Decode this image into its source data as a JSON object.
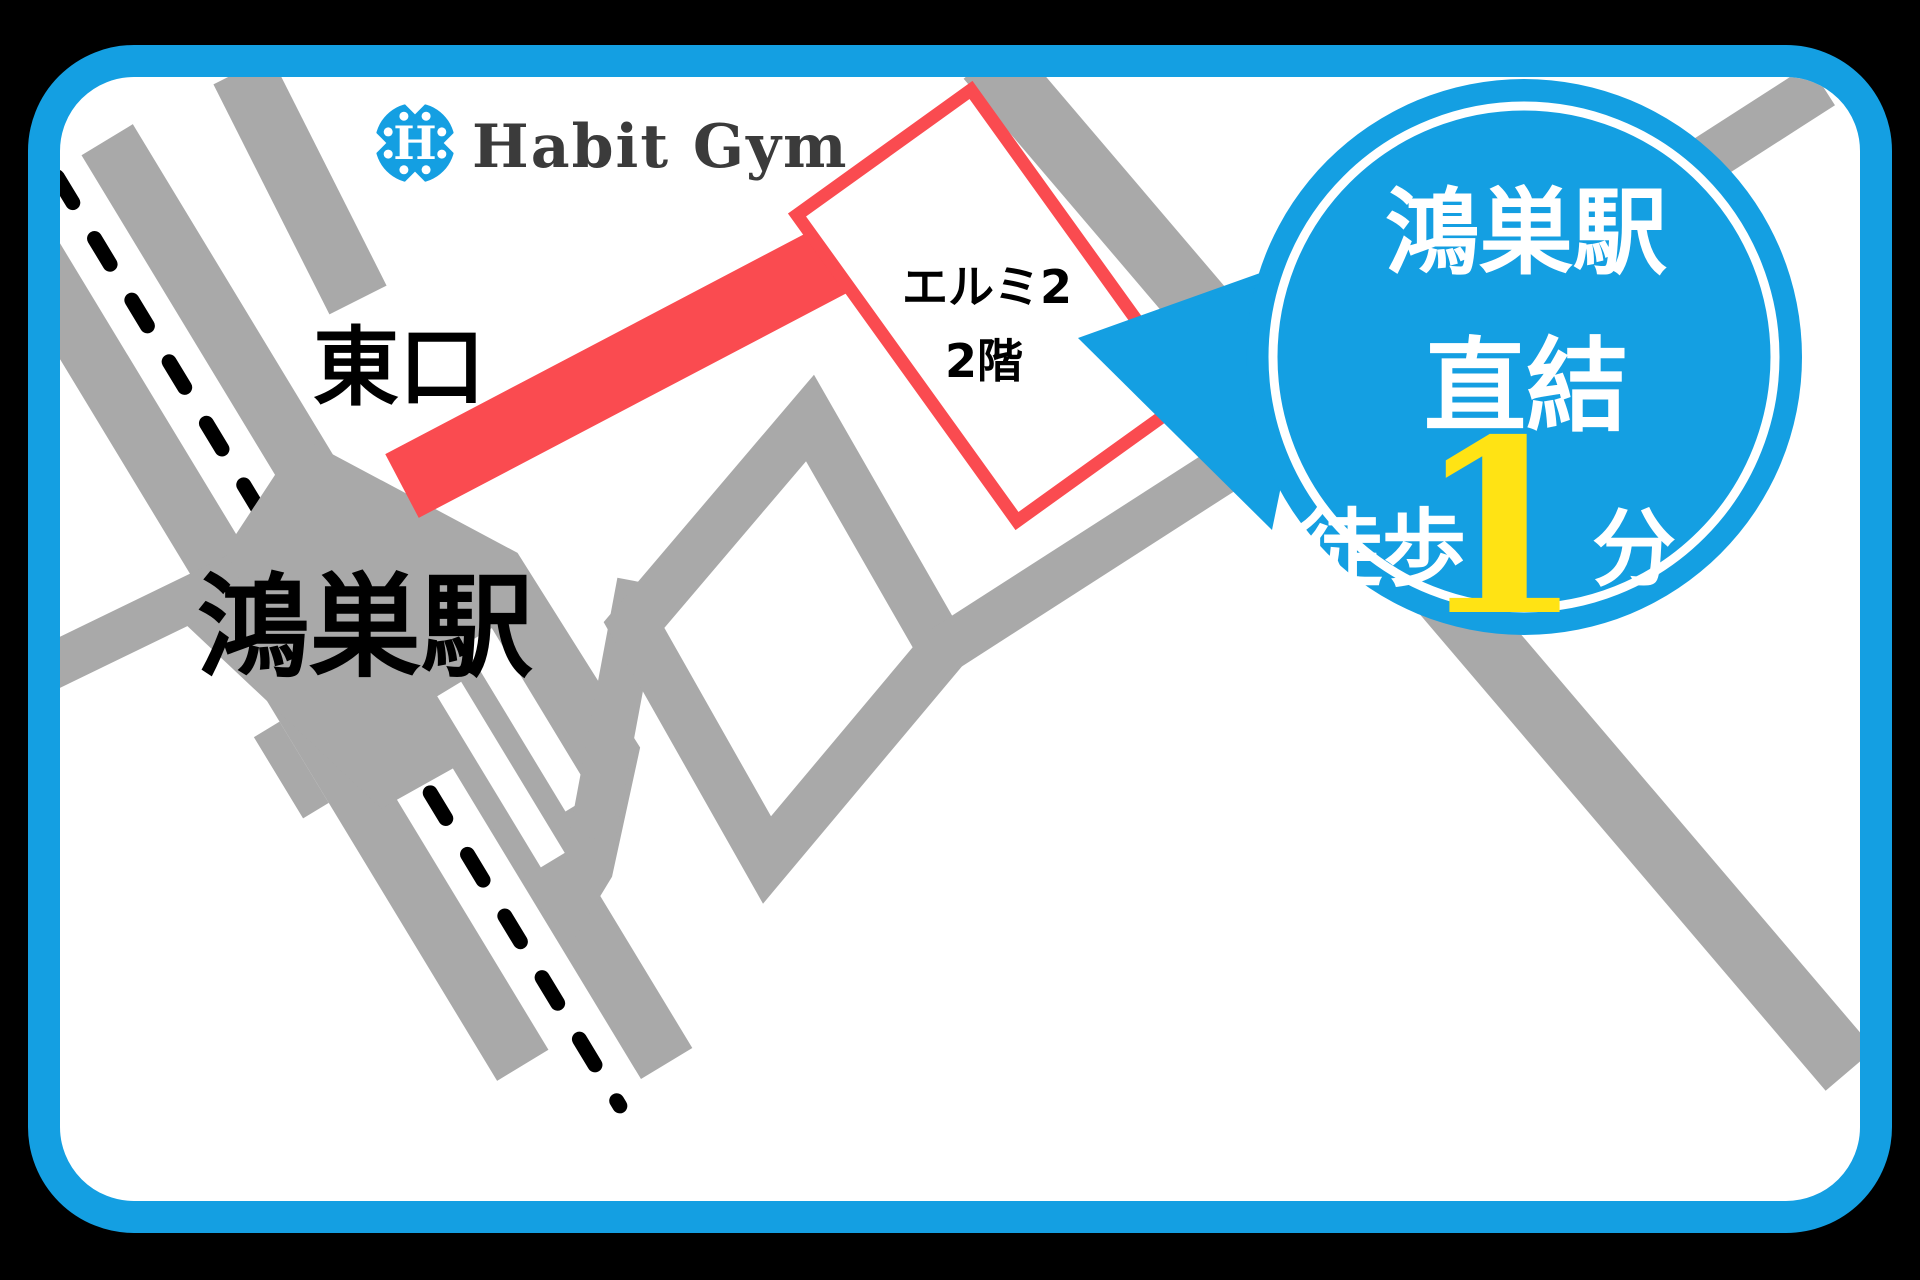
{
  "logo": {
    "icon_letter": "H",
    "name": "Habit Gym"
  },
  "map": {
    "station_label": "鴻巣駅",
    "east_exit_label": "東口",
    "building_label_line1": "エルミ2",
    "building_label_line2": "2階"
  },
  "badge": {
    "line1": "鴻巣駅",
    "line2": "直結",
    "walk_label": "徒歩",
    "minutes_value": "1",
    "minutes_unit": "分"
  },
  "colors": {
    "brand_blue": "#149fe2",
    "route_red": "#fa4b50",
    "road_gray": "#a9a9a9",
    "accent_yellow": "#ffe314",
    "logo_text": "#3b3b3b",
    "outer_background": "#000000",
    "map_background": "#ffffff"
  }
}
